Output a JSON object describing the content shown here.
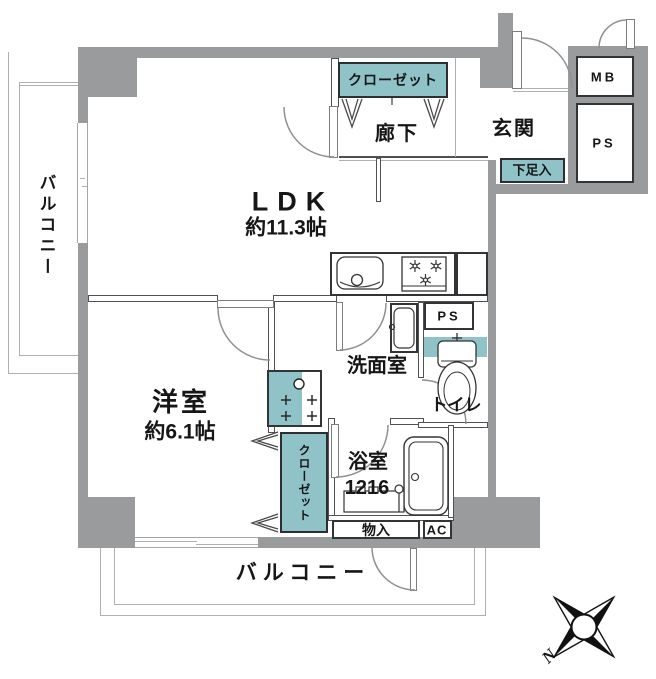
{
  "title": "apartment-floor-plan",
  "rooms": {
    "ldk": {
      "label": "LDK",
      "area": "約11.3帖"
    },
    "bedroom": {
      "label": "洋室",
      "area": "約6.1帖"
    },
    "bathroom": {
      "label": "浴室",
      "size": "1216"
    },
    "washroom": {
      "label": "洗面室"
    },
    "toilet": {
      "label": "トイレ"
    },
    "hallway": {
      "label": "廊下"
    },
    "entrance": {
      "label": "玄関"
    },
    "hall_closet": {
      "label": "クローゼット"
    },
    "bedroom_closet": {
      "label": "クローゼット"
    },
    "shoe_cabinet": {
      "label": "下足入"
    },
    "storage": {
      "label": "物入"
    },
    "air_conditioner": {
      "label": "AC"
    },
    "meter_box": {
      "label": "MB"
    },
    "pipe_shaft_upper": {
      "label": "PS"
    },
    "pipe_shaft_kitchen": {
      "label": "PS"
    },
    "balcony_left": {
      "label": "バルコニー"
    },
    "balcony_bottom": {
      "label": "バルコニー"
    }
  },
  "compass": {
    "north_label": "N"
  },
  "colors": {
    "wall_gray": "#9a9b9d",
    "fixture_teal": "#8fc3c8",
    "line_dark": "#515155"
  }
}
